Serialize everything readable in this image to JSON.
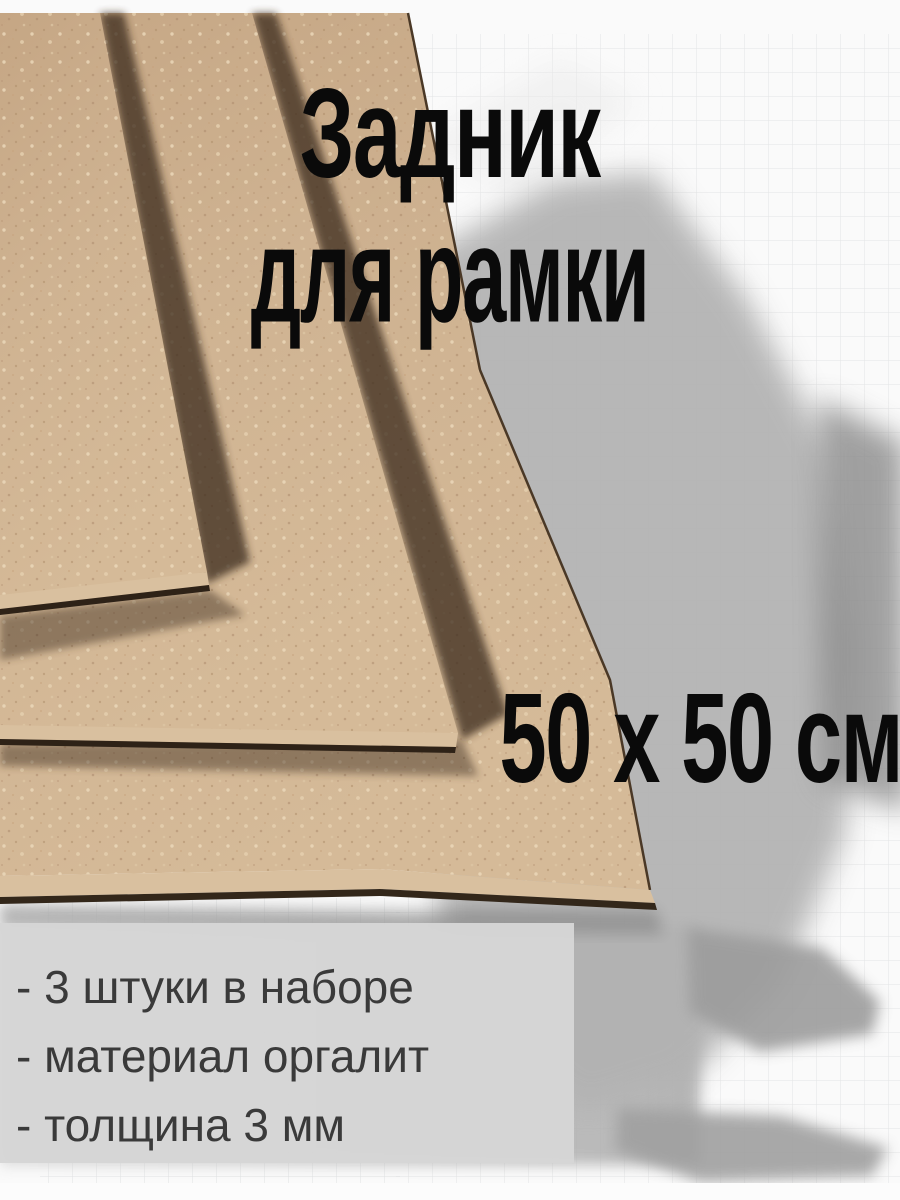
{
  "product": {
    "title_line1": "Задник",
    "title_line2": "для рамки",
    "size_label": "50 х 50 см"
  },
  "panel": {
    "items": [
      "- 3 штуки в наборе",
      "- материал оргалит",
      "- толщина 3 мм"
    ]
  },
  "scene": {
    "board_material_name": "оргалит",
    "board_count": "3",
    "background_style": "gray brush wash over graph paper"
  },
  "colors": {
    "board_tan": "#cdb190",
    "board_edge_face": "#d9c09f",
    "board_shadow_brown": "#3a2c1e",
    "background_white": "#fafafa",
    "wash_gray": "#b2b2b2",
    "wash_dark_gray": "#8a8a8a",
    "grid_line": "#c6c9cc",
    "panel_gray": "#d6d6d6",
    "title_text": "#0a0a0a",
    "panel_text": "#3a3a3a"
  }
}
